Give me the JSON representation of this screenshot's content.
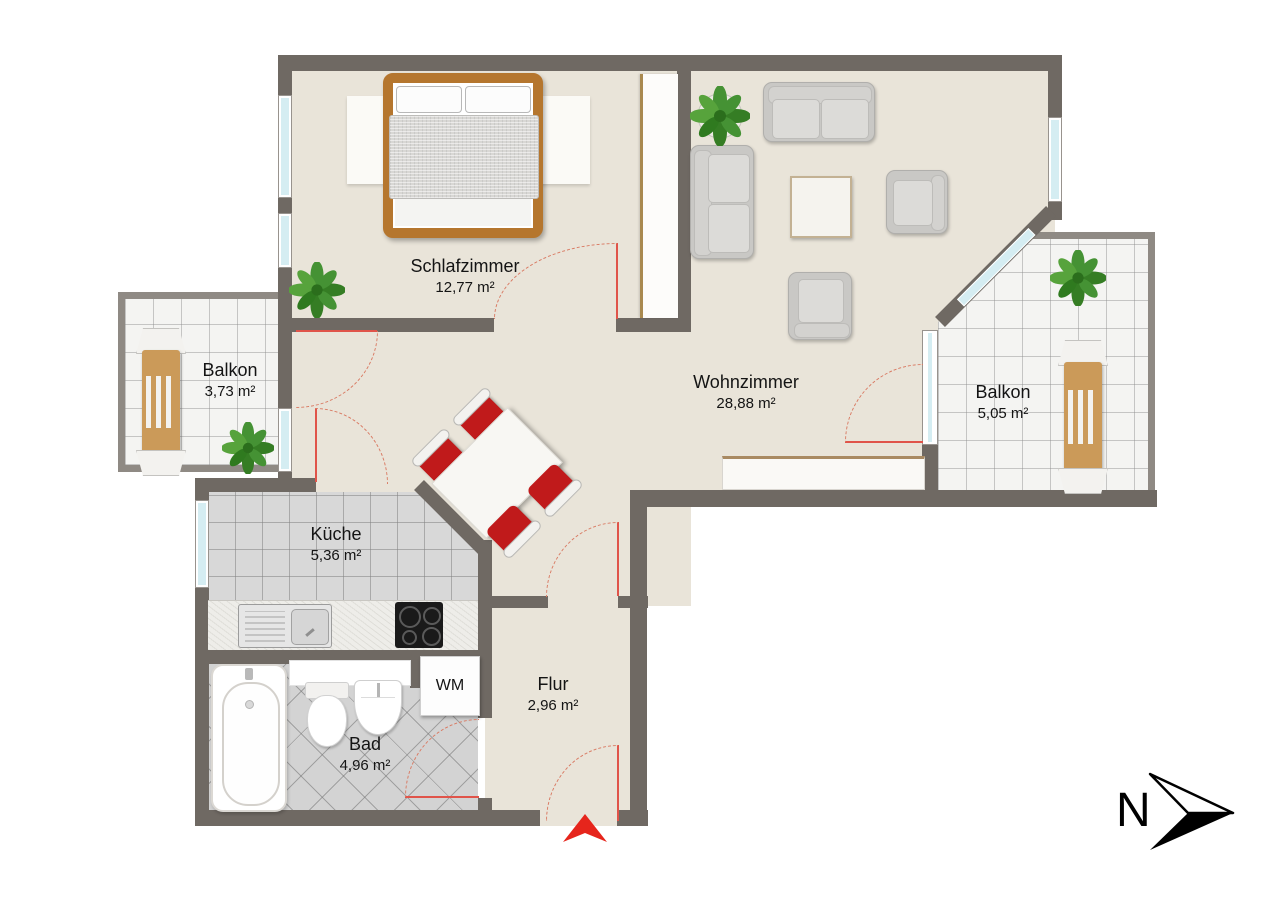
{
  "rooms": {
    "schlafzimmer": {
      "name": "Schlafzimmer",
      "area": "12,77 m²"
    },
    "wohnzimmer": {
      "name": "Wohnzimmer",
      "area": "28,88 m²"
    },
    "balkon_links": {
      "name": "Balkon",
      "area": "3,73 m²"
    },
    "balkon_rechts": {
      "name": "Balkon",
      "area": "5,05 m²"
    },
    "kueche": {
      "name": "Küche",
      "area": "5,36 m²"
    },
    "flur": {
      "name": "Flur",
      "area": "2,96 m²"
    },
    "bad": {
      "name": "Bad",
      "area": "4,96 m²"
    }
  },
  "appliances": {
    "washing_machine": "WM"
  },
  "compass": {
    "north": "N"
  },
  "colors": {
    "wall": "#6f6963",
    "floor": "#e9e4d9",
    "kitchen_tile": "#d8d8d8",
    "chair_red": "#c01a1b",
    "door_swing": "#d97b64",
    "window_glass": "#d5edf2",
    "wood": "#b5762e",
    "entrance_arrow": "#e6251c"
  }
}
